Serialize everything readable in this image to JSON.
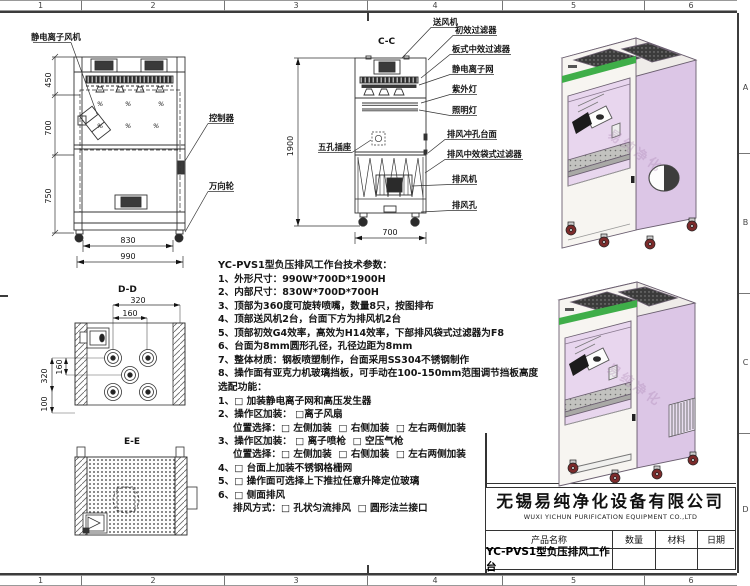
{
  "sheet": {
    "zones_top": [
      "1",
      "2",
      "3",
      "4",
      "5",
      "6"
    ],
    "zones_bottom": [
      "1",
      "2",
      "3",
      "4",
      "5",
      "6"
    ],
    "zone_letters": [
      "A",
      "B",
      "C",
      "D"
    ]
  },
  "front_view": {
    "label_fan": "静电离子风机",
    "label_controller": "控制器",
    "label_caster": "万向轮",
    "dim_450": "450",
    "dim_700": "700",
    "dim_750": "750",
    "dim_830": "830",
    "dim_990": "990"
  },
  "section_view": {
    "title": "C-C",
    "dim_h": "1900",
    "dim_w": "700",
    "label_socket": "五孔插座",
    "labels": [
      "送风机",
      "初效过滤器",
      "板式中效过滤器",
      "静电离子网",
      "紫外灯",
      "照明灯",
      "排风冲孔台面",
      "排风中效袋式过滤器",
      "排风机",
      "排风孔"
    ]
  },
  "dd_view": {
    "title": "D-D",
    "dim_320t": "320",
    "dim_160t": "160",
    "dim_320l": "320",
    "dim_160l": "160",
    "dim_100": "100"
  },
  "ee_view": {
    "title": "E-E"
  },
  "specs": {
    "title": "YC-PVS1型负压排风工作台技术参数：",
    "items": [
      "1、外形尺寸：990W*700D*1900H",
      "2、内部尺寸：830W*700D*700H",
      "3、顶部为360度可旋转喷嘴，数量8只，按图排布",
      "4、顶部送风机2台，台面下方为排风机2台",
      "5、顶部初效G4效率，高效为H14效率，下部排风袋式过滤器为F8",
      "6、台面为8mm圆形孔径，孔径边距为8mm",
      "7、整体材质：钢板喷塑制作，台面采用SS304不锈钢制作",
      "8、操作面有亚克力机玻璃挡板，可手动在100-150mm范围调节挡板高度"
    ],
    "options_title": "选配功能：",
    "options": [
      "1、□ 加装静电离子网和高压发生器",
      "2、操作区加装： □离子风扇",
      "位置选择：□ 左侧加装  □ 右侧加装  □ 左右两侧加装",
      "3、操作区加装： □ 离子喷枪  □ 空压气枪",
      "位置选择：□ 左侧加装  □ 右侧加装  □ 左右两侧加装",
      "4、□ 台面上加装不锈钢格栅网",
      "5、□ 操作面可选择上下推拉任意升降定位玻璃",
      "6、□ 侧面排风",
      "排风方式：□ 孔状匀流排风  □ 圆形法兰接口"
    ]
  },
  "title_block": {
    "company_cn": "无锡易纯净化设备有限公司",
    "company_en": "WUXI YICHUN PURIFICATION EQUIPMENT CO.,LTD",
    "col_product": "产品名称",
    "col_qty": "数量",
    "col_material": "材料",
    "col_date": "日期",
    "product_name": "YC-PVS1型负压排风工作台"
  },
  "watermark": "易纯净化",
  "colors": {
    "panel": "#dcc6e6",
    "stripe": "#3fae49",
    "wheel": "#7d2b2b"
  }
}
